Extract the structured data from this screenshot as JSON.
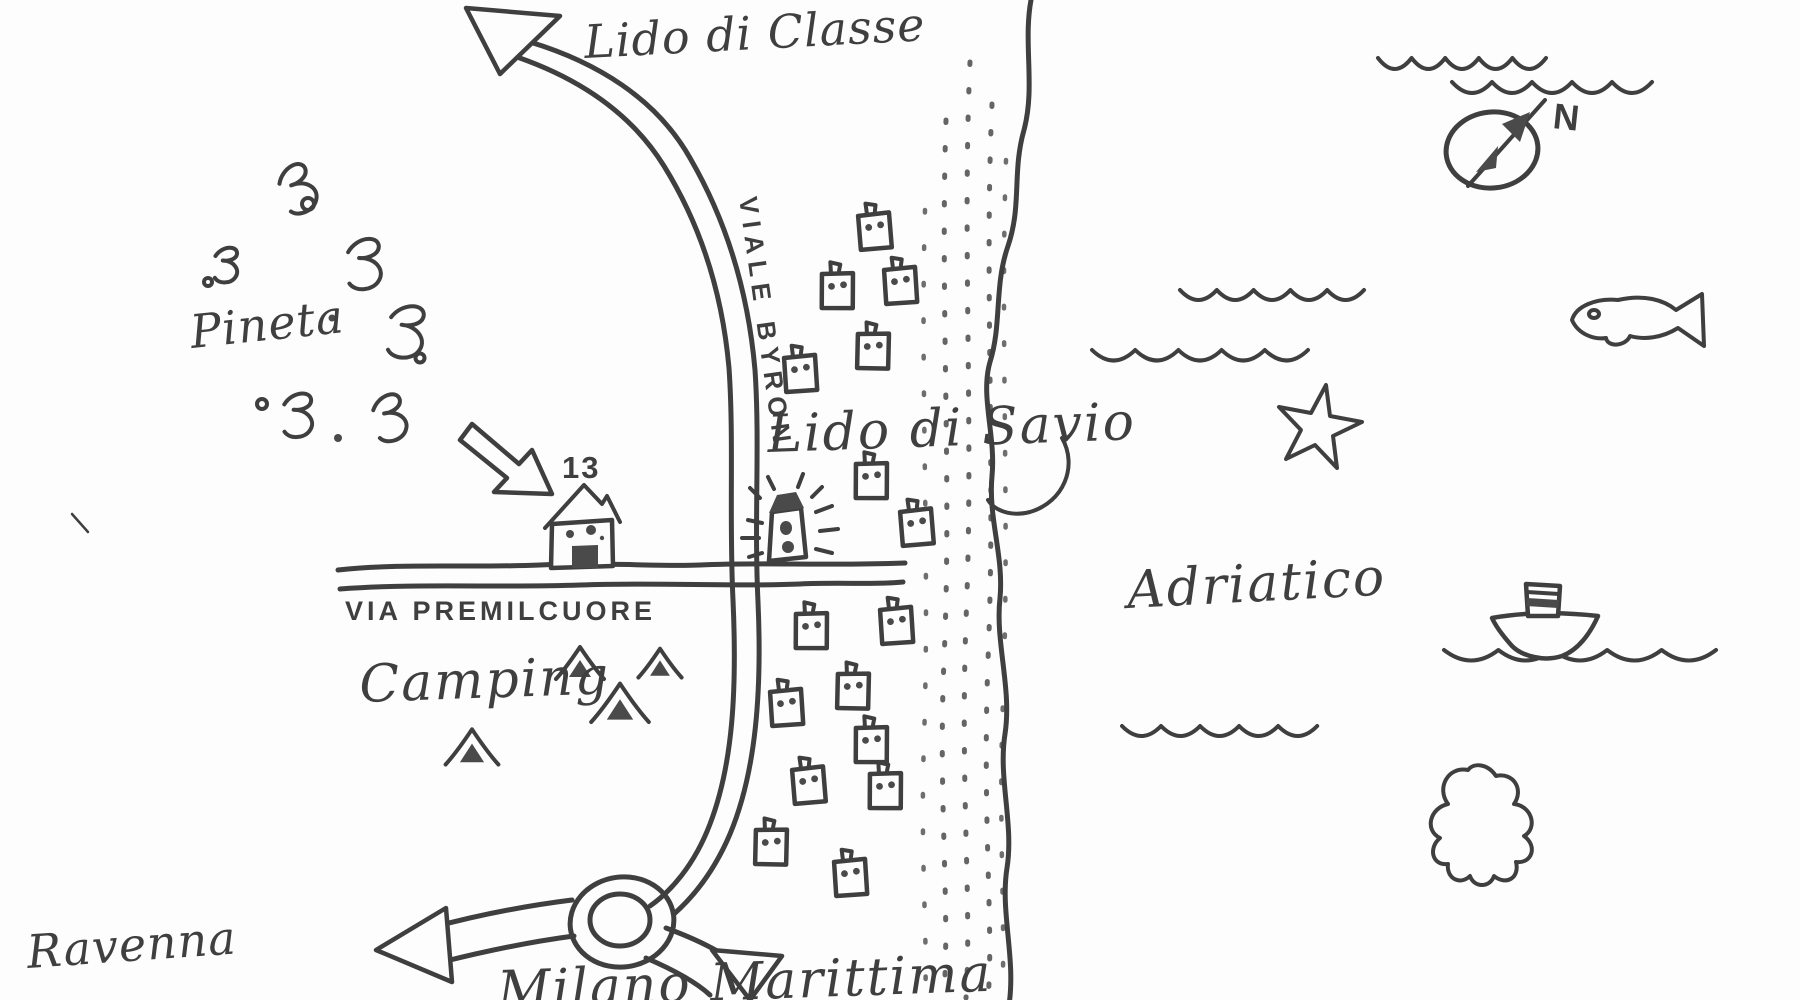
{
  "title": "Hand-drawn sketch map of Lido di Savio and the Adriatic coast",
  "colors": {
    "ink": "#3f3f3f",
    "ink_fill": "#4a4a4a",
    "paper": "#fdfdfd"
  },
  "labels": {
    "lido_di_classe": "Lido di Classe",
    "viale_byron": "VIALE BYRON",
    "pineta": "Pineta",
    "house_number": "13",
    "via_premilcuore": "VIA PREMILCUORE",
    "camping": "Camping",
    "lido_di_savio": "Lido di Savio",
    "adriatico": "Adriatico",
    "ravenna": "Ravenna",
    "milano_marittima": "Milano Marittima",
    "compass_north": "N"
  },
  "icons": {
    "compass": "circle-with-northeast-arrow",
    "lighthouse": "beacon-tower-with-rays",
    "house": "house-with-dark-door-number-13",
    "tent": "campground-tent-triangle",
    "building": "small-square-building-with-windows",
    "fish": "fish-outline",
    "starfish": "starfish-outline",
    "boat": "steamboat-with-striped-funnel",
    "octopus": "octopus-blob-outline",
    "wave": "scalloped-sea-wave-line",
    "bush": "pine-forest-scribble",
    "sand": "stippled-beach-dots",
    "roundabout": "double-circle-roundabout",
    "arrow": "hollow-direction-arrow"
  }
}
